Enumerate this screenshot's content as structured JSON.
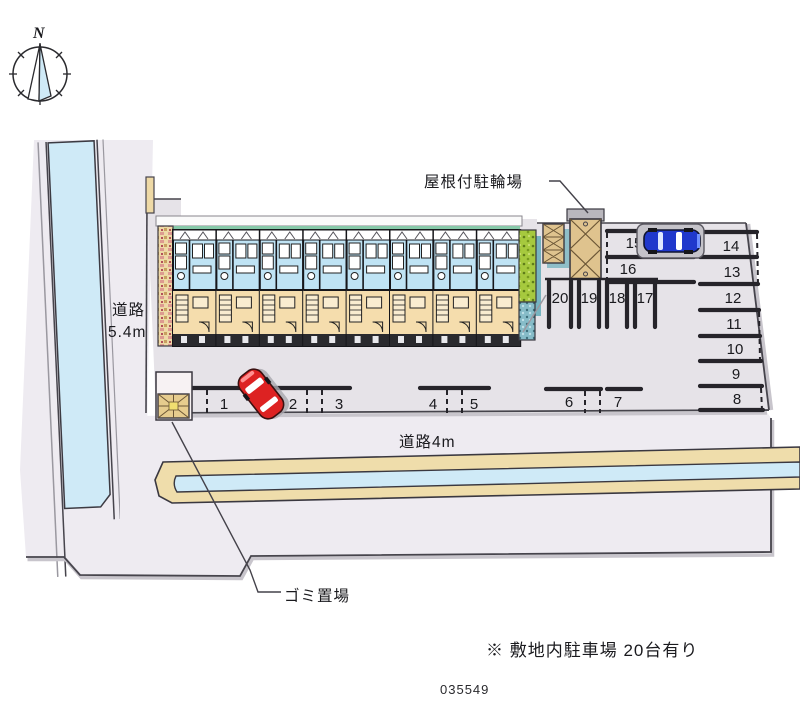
{
  "compass": {
    "north": "N"
  },
  "labels": {
    "bike_shed": "屋根付駐輪場",
    "road_left_name": "道路",
    "road_left_width": "5.4m",
    "road_bottom": "道路4m",
    "garbage": "ゴミ置場",
    "note": "※ 敷地内駐車場 20台有り",
    "plan_id": "035549"
  },
  "parking": {
    "total_note": "20台有り",
    "spaces": [
      "1",
      "2",
      "3",
      "4",
      "5",
      "6",
      "7",
      "8",
      "9",
      "10",
      "11",
      "12",
      "13",
      "14",
      "15",
      "16",
      "17",
      "18",
      "19",
      "20"
    ]
  },
  "colors": {
    "road": "#eeebf1",
    "lot": "#e6e3e8",
    "water": "#cfeaf7",
    "canal_bank": "#efddab",
    "room_upper": "#bfe3f4",
    "room_lower": "#f5ddad",
    "hedge_green": "#a6c93e",
    "shed_tan": "#dfc38e",
    "car_red": "#dd2222",
    "car_blue": "#2038cc",
    "line_dark": "#2b2930"
  }
}
